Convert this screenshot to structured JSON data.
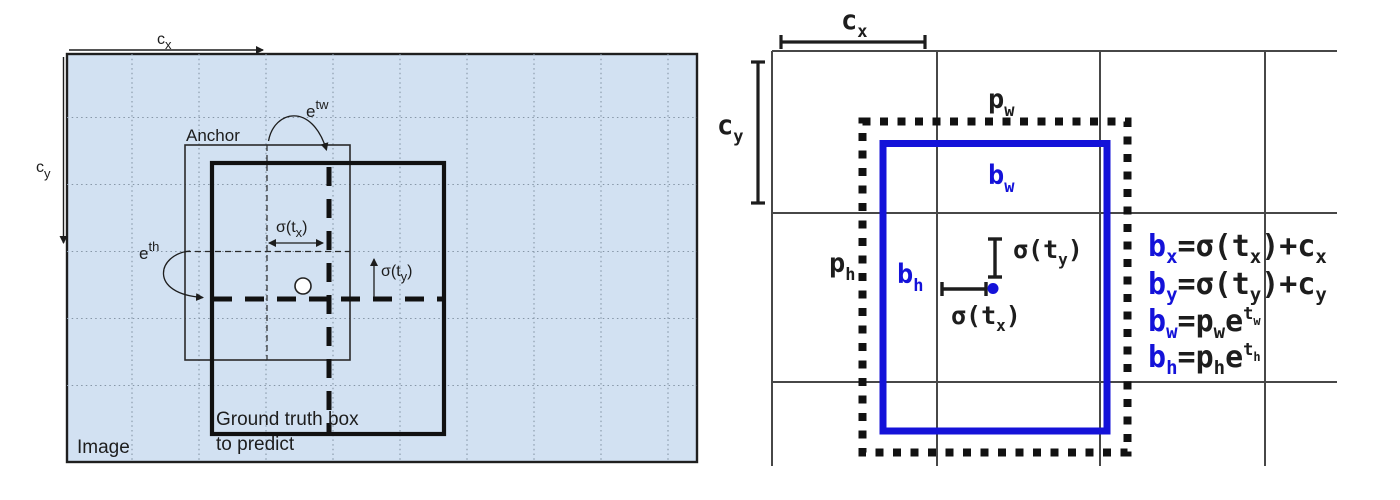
{
  "figure": {
    "description_left": "anchor and ground truth box in image grid",
    "description_right": "bounding box prediction with prior",
    "colors": {
      "left_background": "#d2e1f2",
      "left_grid_dots": "#8696a7",
      "blue_box": "#1412d9",
      "black_line": "#1d1d1d",
      "right_grid_gray": "#474747"
    }
  },
  "left_panel": {
    "image_label": "Image",
    "anchor_label": "Anchor",
    "ground_truth_label_line1": "Ground truth box",
    "ground_truth_label_line2": "to predict",
    "cx_label": {
      "base": "c",
      "sub": "x"
    },
    "cy_label": {
      "base": "c",
      "sub": "y"
    },
    "etw_label": {
      "base": "e",
      "sup": "tw"
    },
    "eth_label": {
      "base": "e",
      "sup": "th"
    },
    "sigma_tx_label": {
      "pre": "σ(t",
      "sub": "x",
      "post": ")"
    },
    "sigma_ty_label": {
      "pre": "σ(t",
      "sub": "y",
      "post": ")"
    }
  },
  "right_panel": {
    "cx_label": {
      "base": "c",
      "sub": "x"
    },
    "cy_label": {
      "base": "c",
      "sub": "y"
    },
    "pw_label": {
      "base": "p",
      "sub": "w"
    },
    "ph_label": {
      "base": "p",
      "sub": "h"
    },
    "bw_label": {
      "base": "b",
      "sub": "w"
    },
    "bh_label": {
      "base": "b",
      "sub": "h"
    },
    "sigma_tx_label": {
      "pre": "σ(t",
      "sub": "x",
      "post": ")"
    },
    "sigma_ty_label": {
      "pre": "σ(t",
      "sub": "y",
      "post": ")"
    },
    "equations": [
      {
        "lhs": "b",
        "lhs_sub": "x",
        "mid": "=σ(t",
        "mid_sub": "x",
        "tail": ")+c",
        "tail_sub": "x"
      },
      {
        "lhs": "b",
        "lhs_sub": "y",
        "mid": "=σ(t",
        "mid_sub": "y",
        "tail": ")+c",
        "tail_sub": "y"
      },
      {
        "lhs": "b",
        "lhs_sub": "w",
        "mid": "=p",
        "mid_sub": "w",
        "base2": "e",
        "sup": "t",
        "sup_sub": "w"
      },
      {
        "lhs": "b",
        "lhs_sub": "h",
        "mid": "=p",
        "mid_sub": "h",
        "base2": "e",
        "sup": "t",
        "sup_sub": "h"
      }
    ]
  }
}
